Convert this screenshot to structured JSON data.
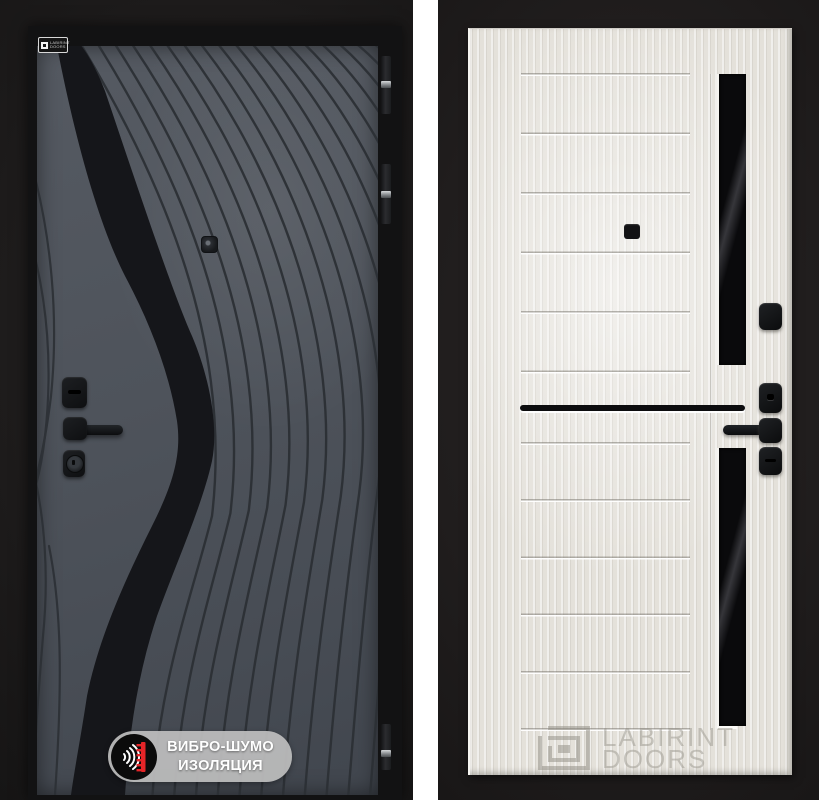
{
  "left_door": {
    "view": "exterior-panel",
    "brand_label": {
      "line1": "LABIRINT",
      "line2": "DOORS"
    },
    "badge": {
      "line1": "ВИБРО-ШУМО",
      "line2": "ИЗОЛЯЦИЯ"
    },
    "colors": {
      "panel_gray": "#4e535b",
      "pattern_dark": "#2c3035",
      "hardware_black": "#141619",
      "badge_background": "#bdbdbd",
      "badge_icon_red": "#e52528"
    }
  },
  "right_door": {
    "view": "interior-panel",
    "watermark": {
      "line1": "LABIRINT",
      "line2": "DOORS"
    },
    "colors": {
      "panel_cream": "#e9e6e0",
      "glass_black": "#0a0a0c",
      "hardware_black": "#131315"
    }
  }
}
